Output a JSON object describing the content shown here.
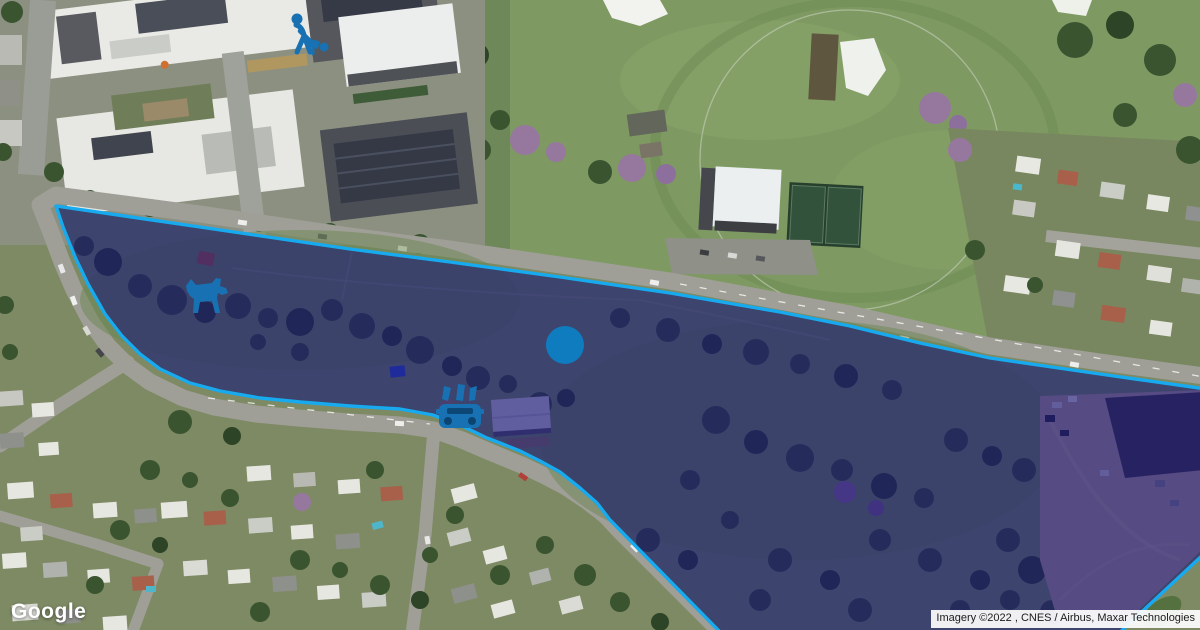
{
  "branding": {
    "logo_text": "Google"
  },
  "attribution": {
    "text": "Imagery ©2022 , CNES / Airbus, Maxar Technologies"
  },
  "overlay": {
    "label": "highlighted park boundary",
    "points": "56,206 200,227 350,249 450,262 560,277 670,293 780,312 850,326 920,343 990,358 1100,374 1206,389 1206,552 1118,634 722,634 610,520 597,503 580,488 560,472 540,461 520,451 500,443 487,438 460,425 433,415 400,409 350,406 300,402 260,398 220,391 190,383 160,369 140,354 122,336 105,314 88,284 75,257 63,227",
    "fill": "rgba(24,18,120,0.60)",
    "stroke": "#18aaee"
  },
  "markers": {
    "person_activity": {
      "transform": "translate(297,40)"
    },
    "dog_park": {
      "transform": "translate(206,295)"
    },
    "location_dot": {
      "transform": "translate(565,345)",
      "radius": 19
    },
    "car_wash": {
      "transform": "translate(460,410)"
    }
  },
  "colors": {
    "icon_blue": "#1871b2",
    "dot_blue": "#0f7cc0",
    "overlay_fill": "rgba(24,18,120,0.60)",
    "overlay_stroke": "#18aaee"
  }
}
